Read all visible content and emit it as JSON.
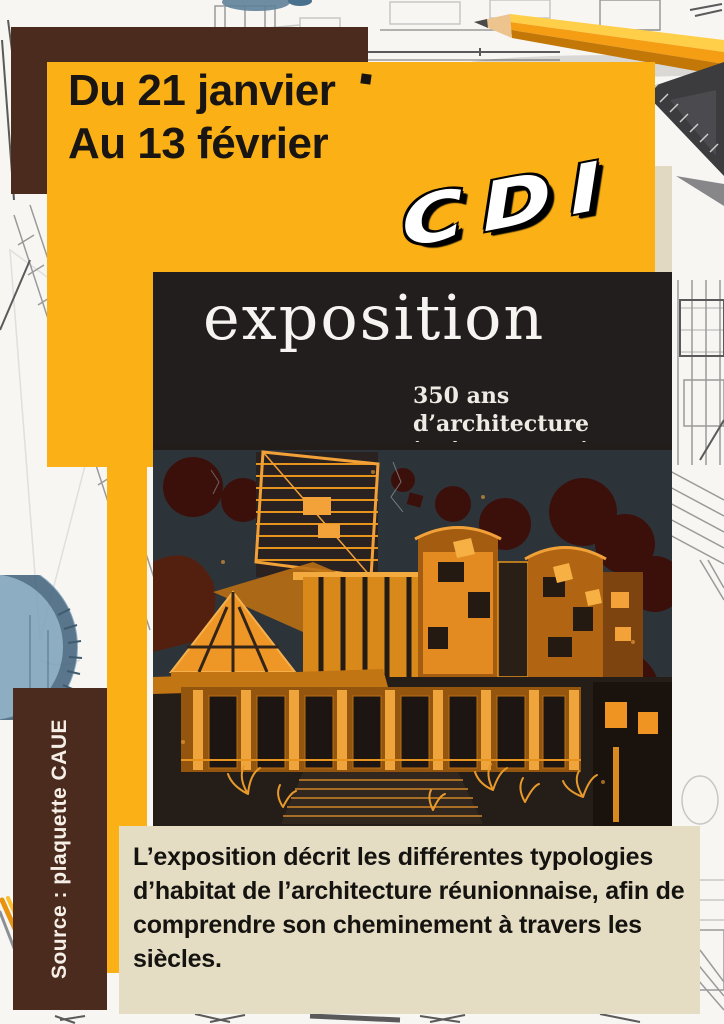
{
  "dates": {
    "line1": "Du 21 janvier",
    "line2": "Au 13 février"
  },
  "logo": {
    "text": "CDI"
  },
  "expo": {
    "title": "exposition",
    "subtitle_line1": "350 ans d’architecture",
    "subtitle_line2": "à l’île de la Réunion"
  },
  "description": {
    "text": "L’exposition décrit les différentes typologies d’habitat de l’architecture réunionnaise, afin de comprendre son cheminement à travers les siècles."
  },
  "source": {
    "label": "Source : plaquette CAUE"
  },
  "colors": {
    "yellow": "#fbb116",
    "brown": "#4b2b1e",
    "beige": "#e5dcc4",
    "poster_background": "#221e1e",
    "drawing_orange": "#ef9323",
    "sky_slate": "#2d3439",
    "maroon_blobs": "#3b100b",
    "text_dark": "#181512",
    "text_light": "#f5efe7"
  }
}
